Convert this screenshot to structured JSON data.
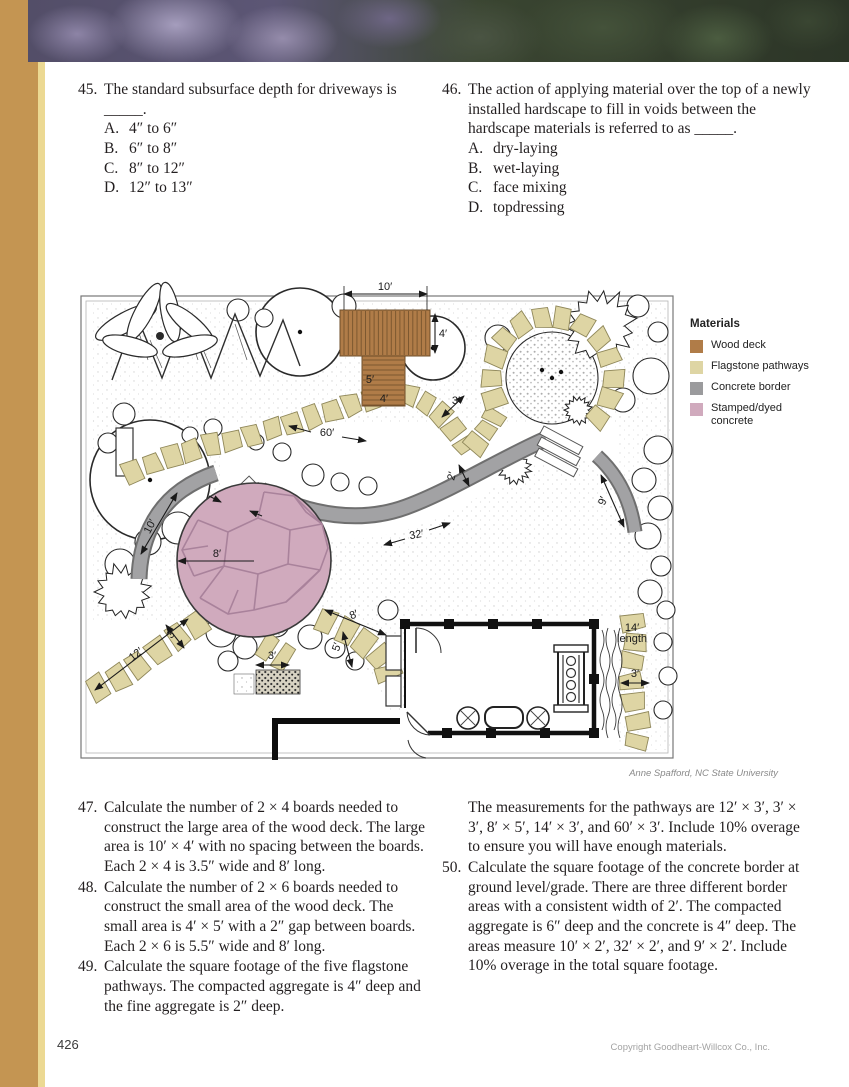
{
  "page": {
    "number": "426",
    "copyright": "Copyright Goodheart-Willcox Co., Inc."
  },
  "figure": {
    "credit": "Anne Spafford, NC State University"
  },
  "legend": {
    "title": "Materials",
    "items": [
      {
        "label": "Wood deck",
        "color": "#b07c48"
      },
      {
        "label": "Flagstone pathways",
        "color": "#ded5a4"
      },
      {
        "label": "Concrete border",
        "color": "#9b9b9d"
      },
      {
        "label": "Stamped/dyed concrete",
        "color": "#d0aabd"
      }
    ]
  },
  "plan": {
    "dimension_labels": [
      {
        "text": "10′"
      },
      {
        "text": "4′"
      },
      {
        "text": "5′"
      },
      {
        "text": "4′"
      },
      {
        "text": "3′"
      },
      {
        "text": "60′"
      },
      {
        "text": "2′"
      },
      {
        "text": "32′"
      },
      {
        "text": "9′"
      },
      {
        "text": "10′"
      },
      {
        "text": "8′"
      },
      {
        "text": "12′"
      },
      {
        "text": "3′"
      },
      {
        "text": "3′"
      },
      {
        "text": "8′"
      },
      {
        "text": "5′"
      },
      {
        "text": "14′"
      },
      {
        "text": "length"
      },
      {
        "text": "3′"
      }
    ]
  },
  "questions_top_left": [
    {
      "number": "45.",
      "text": "The standard subsurface depth for driveways is _____.",
      "choices": [
        {
          "letter": "A.",
          "text": "4″ to 6″"
        },
        {
          "letter": "B.",
          "text": "6″ to 8″"
        },
        {
          "letter": "C.",
          "text": "8″ to 12″"
        },
        {
          "letter": "D.",
          "text": "12″ to 13″"
        }
      ]
    }
  ],
  "questions_top_right": [
    {
      "number": "46.",
      "text": "The action of applying material over the top of a newly installed hardscape to fill in voids between the hardscape materials is referred to as _____.",
      "choices": [
        {
          "letter": "A.",
          "text": "dry-laying"
        },
        {
          "letter": "B.",
          "text": "wet-laying"
        },
        {
          "letter": "C.",
          "text": "face mixing"
        },
        {
          "letter": "D.",
          "text": "topdressing"
        }
      ]
    }
  ],
  "questions_bottom_left": [
    {
      "number": "47.",
      "text": "Calculate the number of 2 × 4 boards needed to construct the large area of the wood deck. The large area is 10′ × 4′ with no spacing between the boards. Each 2 × 4 is 3.5″ wide and 8′ long.",
      "choices": []
    },
    {
      "number": "48.",
      "text": "Calculate the number of 2 × 6 boards needed to construct the small area of the wood deck. The small area is 4′ × 5′ with a 2″ gap between boards. Each 2 × 6 is 5.5″ wide and 8′ long.",
      "choices": []
    },
    {
      "number": "49.",
      "text": "Calculate the square footage of the five flagstone pathways. The compacted aggregate is 4″ deep and the fine aggregate is 2″ deep.",
      "choices": []
    }
  ],
  "questions_bottom_right": [
    {
      "number": "",
      "text": "The measurements for the pathways are 12′ × 3′, 3′ × 3′, 8′ × 5′, 14′ × 3′, and 60′ × 3′. Include 10% overage to ensure you will have enough materials.",
      "choices": []
    },
    {
      "number": "50.",
      "text": "Calculate the square footage of the concrete border at ground level/grade. There are three different border areas with a consistent width of 2′. The compacted aggregate is 6″ deep and the concrete is 4″ deep. The areas measure 10′ × 2′, 32′ × 2′, and 9′ × 2′. Include 10% overage in the total square footage.",
      "choices": []
    }
  ]
}
